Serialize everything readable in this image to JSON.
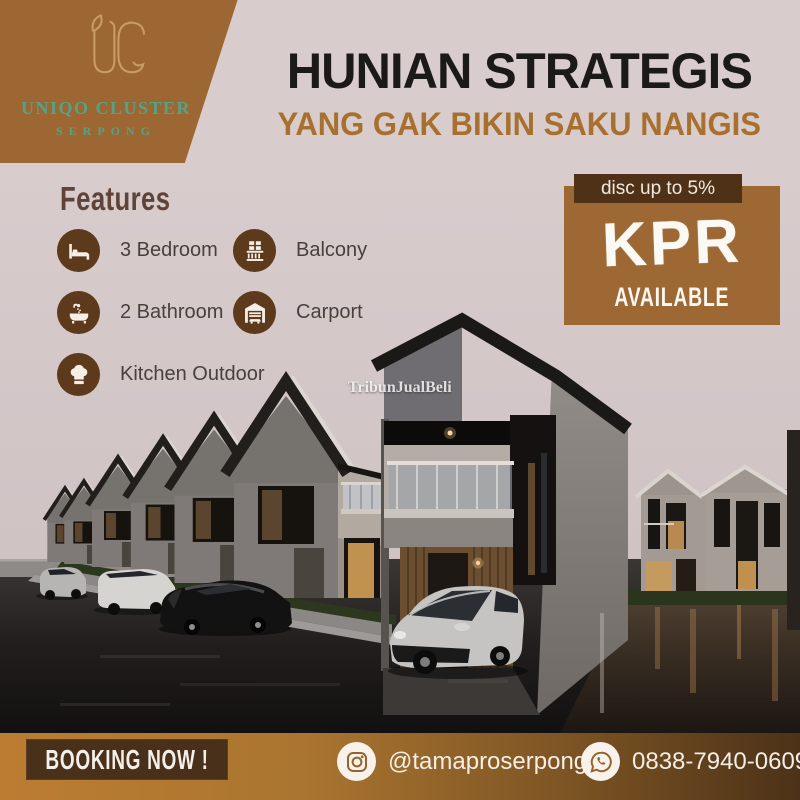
{
  "brand": {
    "monogram": "UC",
    "name": "UNIQO CLUSTER",
    "location": "SERPONG"
  },
  "headline": {
    "title": "HUNIAN STRATEGIS",
    "subtitle": "YANG GAK BIKIN SAKU NANGIS"
  },
  "features": {
    "title": "Features",
    "items": [
      {
        "icon": "bed-icon",
        "label": "3 Bedroom"
      },
      {
        "icon": "bathtub-icon",
        "label": "2 Bathroom"
      },
      {
        "icon": "chef-hat-icon",
        "label": "Kitchen Outdoor"
      },
      {
        "icon": "balcony-icon",
        "label": "Balcony"
      },
      {
        "icon": "carport-icon",
        "label": "Carport"
      }
    ]
  },
  "promo": {
    "discount": "disc up to 5%",
    "program": "KPR",
    "status": "AVAILABLE"
  },
  "watermark": "TribunJualBeli",
  "footer": {
    "booking_label": "BOOKING NOW !",
    "instagram_handle": "@tamaproserpong",
    "whatsapp_number": "0838-7940-0609"
  },
  "colors": {
    "background_pink": "#d8cccd",
    "accent_brown": "#9d6833",
    "dark_brown": "#4f3118",
    "subtitle_brown": "#a8702f",
    "logo_green": "#57a285",
    "logo_gold": "#c89d61"
  }
}
